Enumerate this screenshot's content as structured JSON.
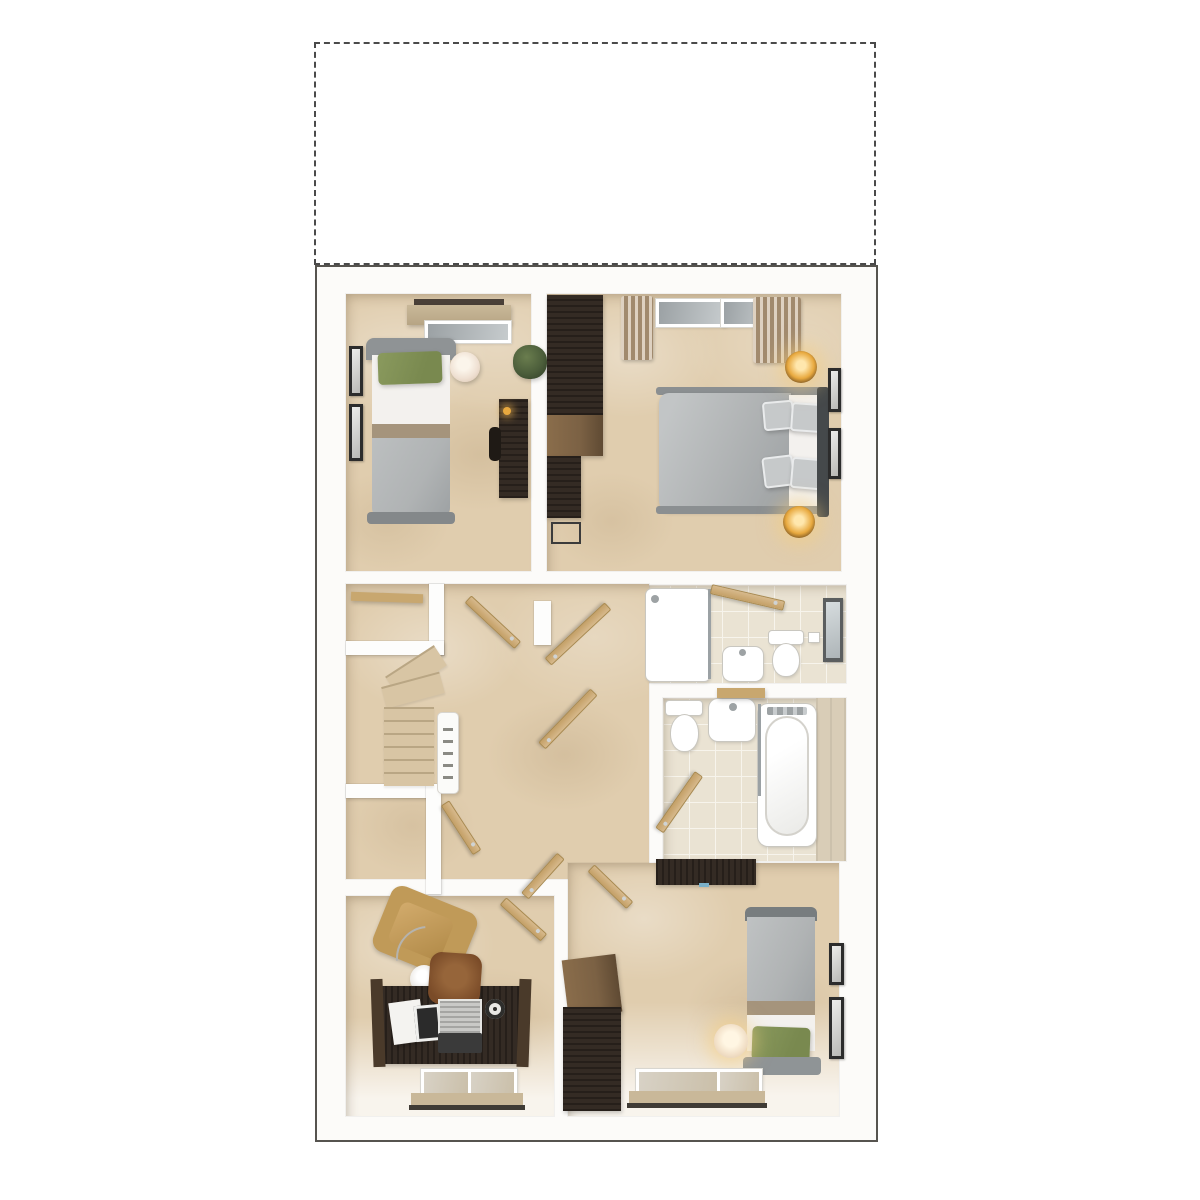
{
  "meta": {
    "description": "3D dollhouse-style upper-floor plan render with an empty dashed placeholder panel above it",
    "visible_text": "none"
  },
  "colors": {
    "page_bg": "#ffffff",
    "dashed_border": "#4a4a4a",
    "plan_border": "#56544f",
    "plan_bg": "#fcfbf9",
    "wall": "#fdfdfc",
    "carpet": "#e0cdae",
    "tile": "#eae3d3",
    "tile_line": "#f7f4ec",
    "duvet": "#b0b3b4",
    "duvet_dark": "#8b8f91",
    "headboard": "#45494b",
    "pillow_gray": "#c6c9ca",
    "green_pillow": "#79894f",
    "tan_band": "#a5947c",
    "mattress": "#f3f1ee",
    "dark_wood": "#342b24",
    "mid_wood": "#7b6144",
    "light_wood": "#c8a76f",
    "door_wood": "#d7b98c",
    "door_edge": "#a8894f",
    "curtain": "#c2ab8e",
    "blind": "#c9b899",
    "pelmet": "#4a4038",
    "glass": "#9ba1a4",
    "glass_light": "#c6cbcd",
    "lamp_warm": "#e8a93f",
    "lamp_glow": "#ffe7ad",
    "lamp_paper": "#efe0d2",
    "fixture": "#ffffff",
    "fixture_line": "#c9c7c0",
    "armchair": "#c09a58",
    "chair_leather": "#7a4b28",
    "frame_dark": "#2c2c2c",
    "plant": "#4c5e3b",
    "stair_tread": "#d8c5a4",
    "stair_edge": "#b9a684",
    "bath_wall_tile": "#d9cdb7"
  },
  "scene": {
    "placeholder_panel": "empty dashed rectangle",
    "rooms": [
      {
        "name": "bedroom-3",
        "position": "top-left",
        "furniture": [
          "window-with-blind",
          "single-bed",
          "green-pillow",
          "paper-lantern-lamp",
          "two-wall-pictures",
          "plant",
          "desk",
          "desk-chair"
        ]
      },
      {
        "name": "bedroom-1-master",
        "position": "top-right",
        "furniture": [
          "two-windows",
          "curtains",
          "double-bed",
          "four-gray-pillows",
          "two-lit-bedside-lamps",
          "tall-wardrobe",
          "dressing-table",
          "stool",
          "two-wall-pictures"
        ]
      },
      {
        "name": "en-suite",
        "position": "mid-right",
        "furniture": [
          "shower-enclosure",
          "basin",
          "toilet",
          "mirror-cabinet",
          "door"
        ]
      },
      {
        "name": "bathroom",
        "position": "mid-right-lower",
        "furniture": [
          "toilet",
          "basin",
          "wall-shelf",
          "bathtub-with-screen",
          "tiled-wall",
          "door"
        ]
      },
      {
        "name": "landing",
        "position": "center",
        "furniture": [
          "winder-staircase",
          "banister",
          "airing-cupboard",
          "store-cupboard",
          "six-door-leaves"
        ]
      },
      {
        "name": "study",
        "position": "bottom-left",
        "furniture": [
          "armchair",
          "arc-floor-lamp",
          "desk",
          "leather-chair",
          "laptop",
          "papers",
          "window-with-blind",
          "door"
        ]
      },
      {
        "name": "bedroom-2",
        "position": "bottom-right",
        "furniture": [
          "wall-shelf",
          "wardrobe",
          "single-bed",
          "green-pillow",
          "lit-table-lamp",
          "two-wall-pictures",
          "window-with-blind",
          "door"
        ]
      }
    ]
  }
}
